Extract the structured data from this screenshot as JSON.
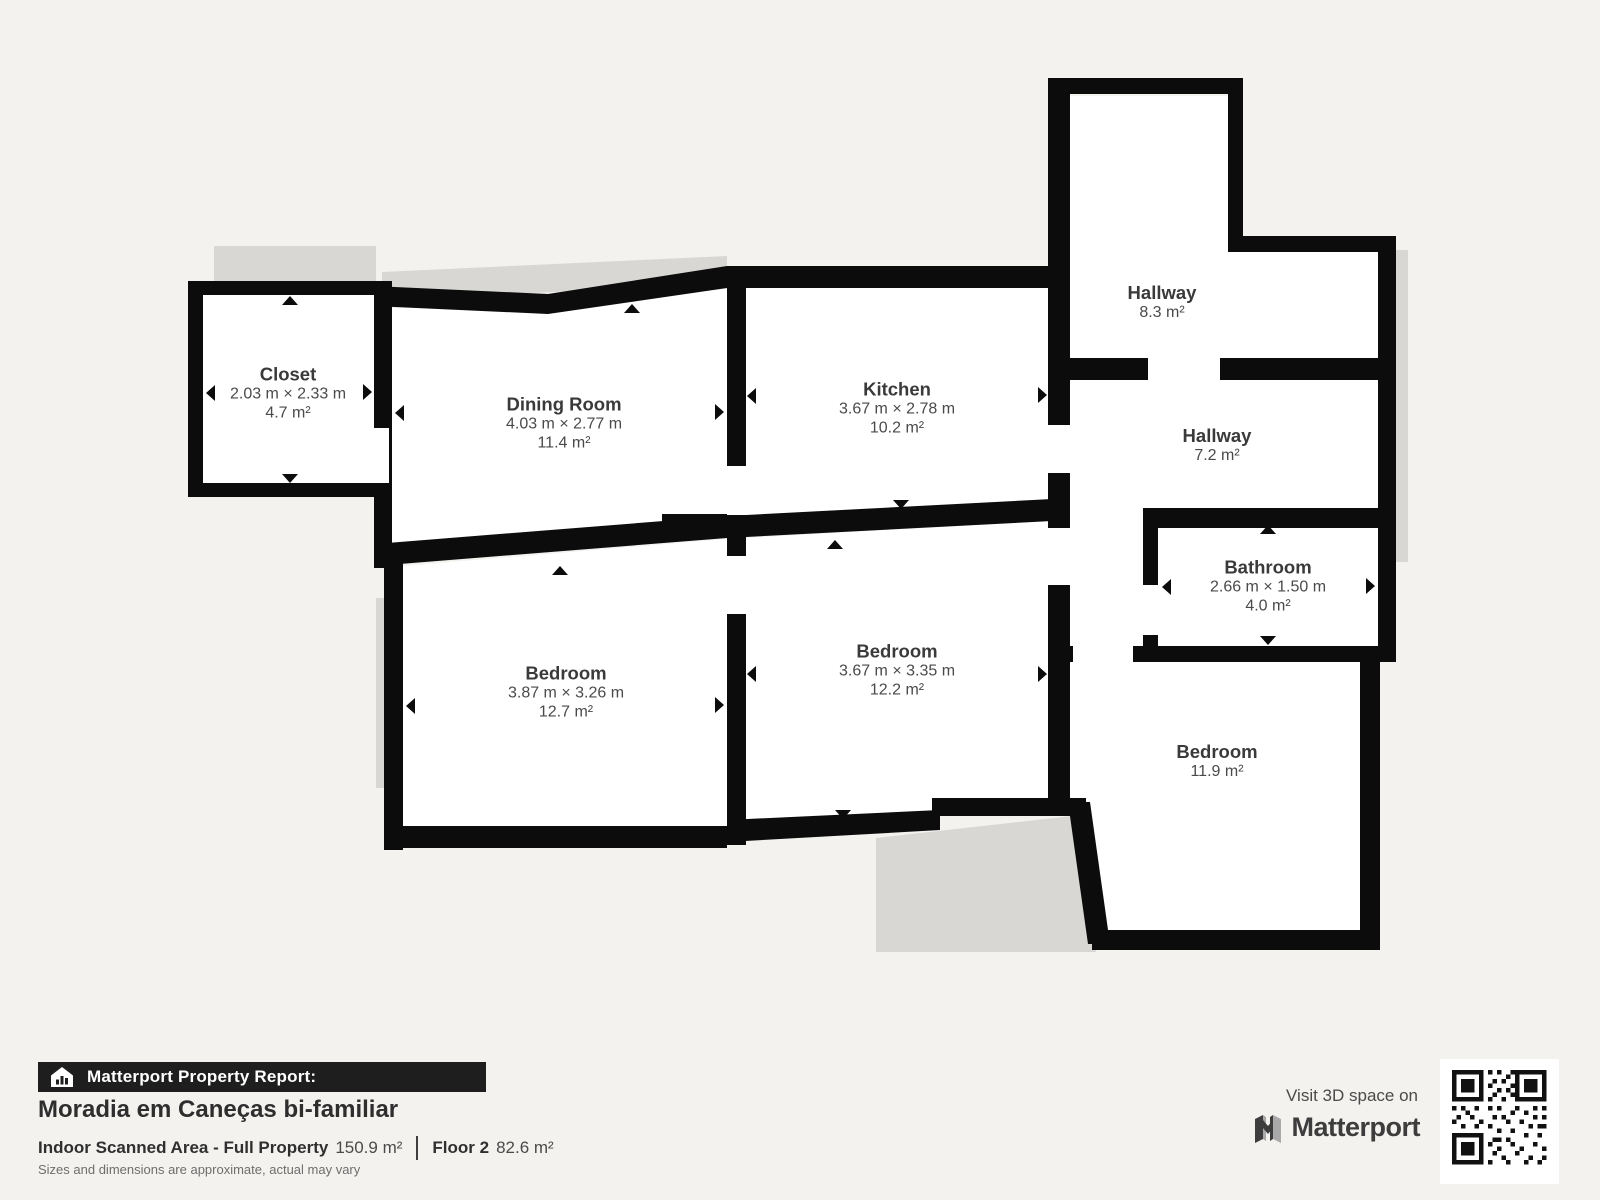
{
  "rooms": [
    {
      "id": "closet",
      "name": "Closet",
      "dims": "2.03 m × 2.33 m",
      "area": "4.7 m²"
    },
    {
      "id": "dining-room",
      "name": "Dining Room",
      "dims": "4.03 m × 2.77 m",
      "area": "11.4 m²"
    },
    {
      "id": "kitchen",
      "name": "Kitchen",
      "dims": "3.67 m × 2.78 m",
      "area": "10.2 m²"
    },
    {
      "id": "hallway-top",
      "name": "Hallway",
      "area": "8.3 m²"
    },
    {
      "id": "hallway-mid",
      "name": "Hallway",
      "area": "7.2 m²"
    },
    {
      "id": "bathroom",
      "name": "Bathroom",
      "dims": "2.66 m × 1.50 m",
      "area": "4.0 m²"
    },
    {
      "id": "bedroom-left",
      "name": "Bedroom",
      "dims": "3.87 m × 3.26 m",
      "area": "12.7 m²"
    },
    {
      "id": "bedroom-middle",
      "name": "Bedroom",
      "dims": "3.67 m × 3.35 m",
      "area": "12.2 m²"
    },
    {
      "id": "bedroom-right",
      "name": "Bedroom",
      "area": "11.9 m²"
    }
  ],
  "footer": {
    "banner_label": "Matterport Property Report:",
    "title": "Moradia em Caneças bi-familiar",
    "scanned_label": "Indoor Scanned Area - Full Property",
    "scanned_value": "150.9 m²",
    "floor_label": "Floor 2",
    "floor_value": "82.6 m²",
    "disclaimer": "Sizes and dimensions are approximate, actual may vary"
  },
  "promo": {
    "visit_text": "Visit 3D space on",
    "brand": "Matterport"
  },
  "icons": {
    "banner_icon": "house-chart-icon",
    "brand_icon": "matterport-m-icon",
    "qr": "qr-code"
  },
  "colors": {
    "background": "#f4f2ef",
    "wall": "#0c0c0c",
    "room_floor": "#ffffff",
    "shadow": "#d8d7d4",
    "banner_bg": "#1e1e1e",
    "text_dark": "#2e2e2e",
    "text_room": "#3a3a3a"
  }
}
